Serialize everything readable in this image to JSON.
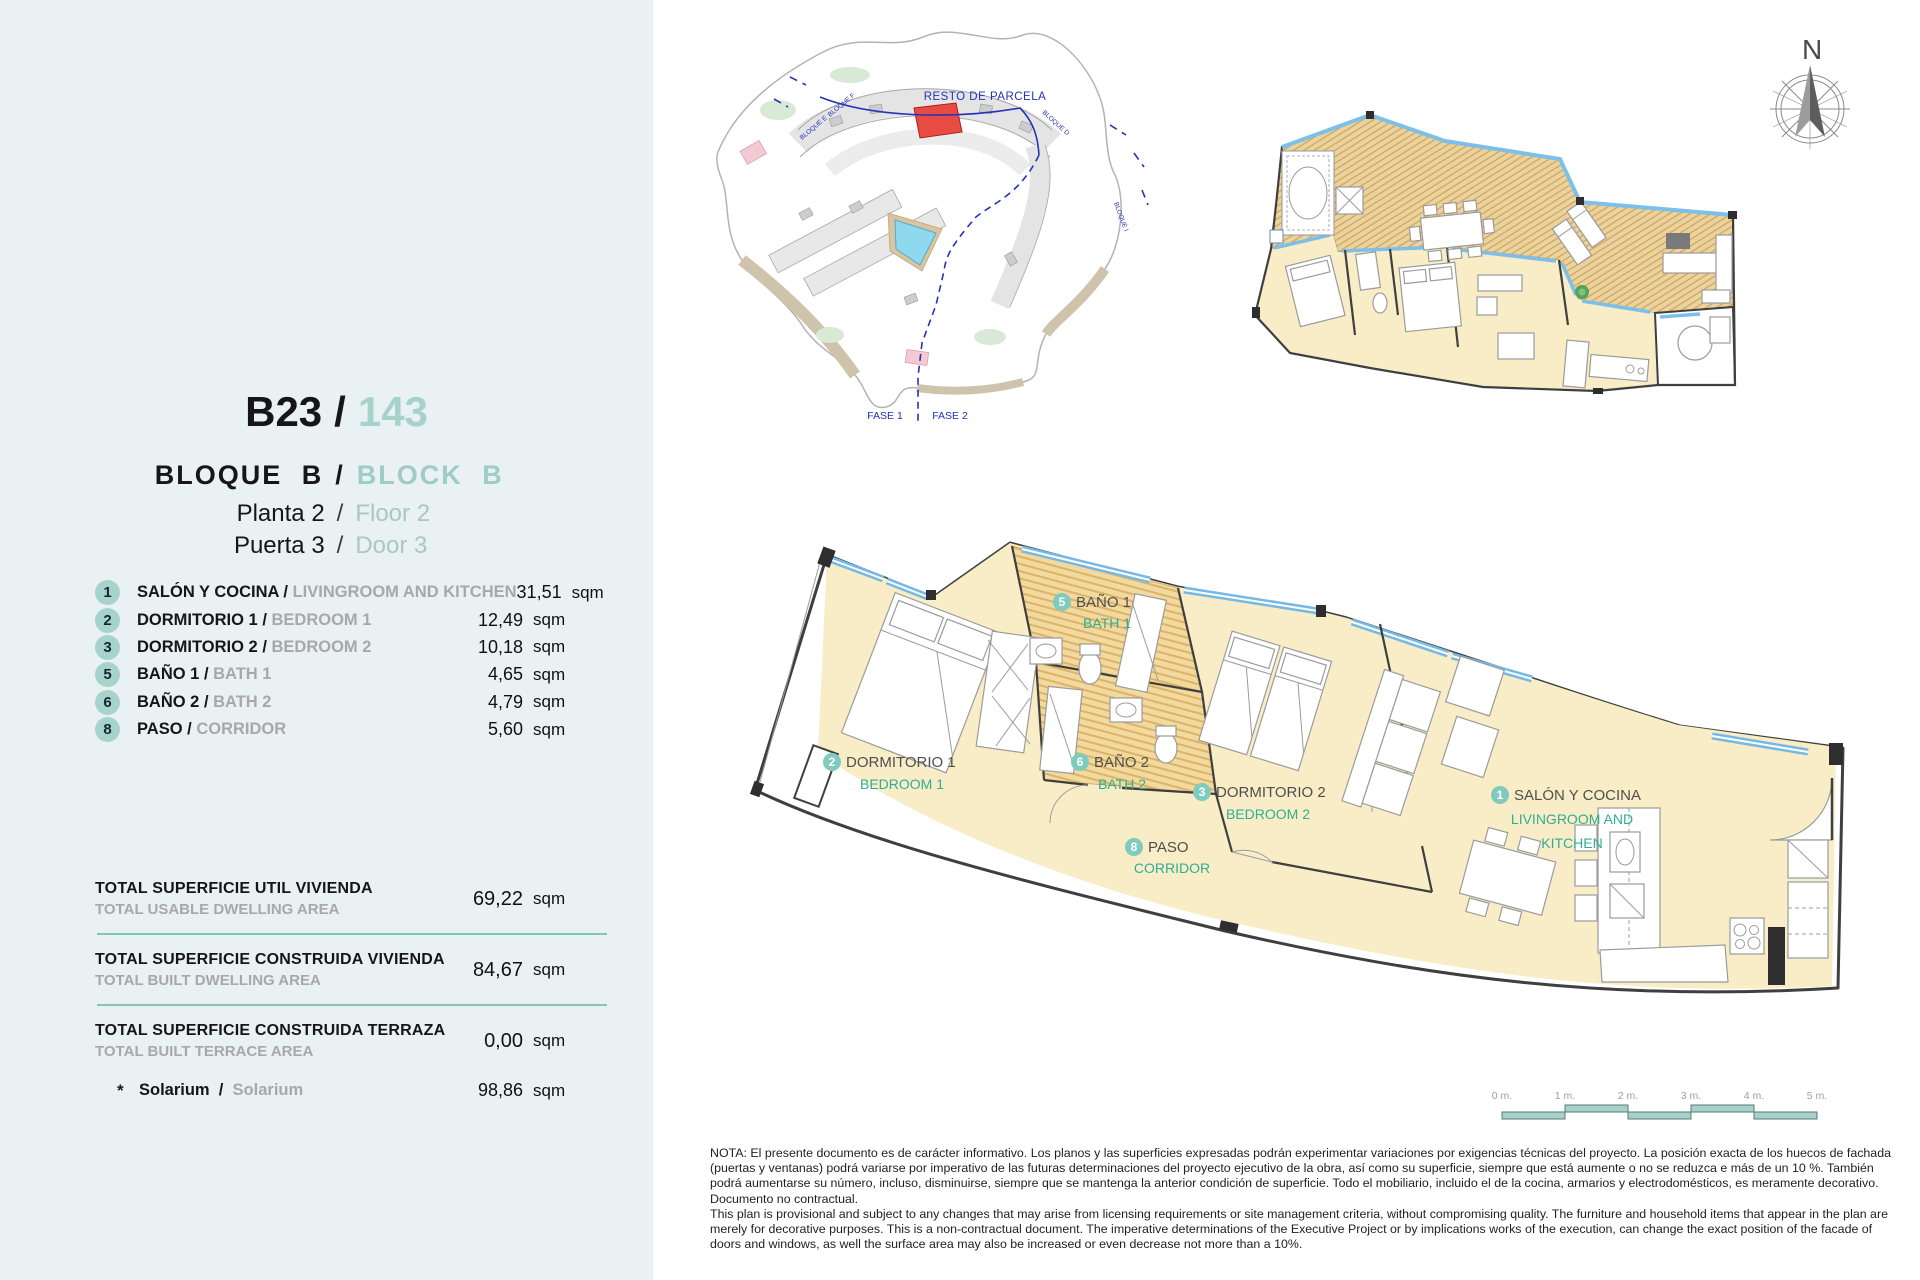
{
  "colors": {
    "panel_bg": "#e9f1f3",
    "accent_teal": "#7fc6bd",
    "badge_teal": "#a6d4cd",
    "label_teal": "#2fae96",
    "muted_gray": "#a8a8a8",
    "room_cream": "#f8edc6",
    "bath_hatch": "#f1d99f",
    "glazing_blue": "#76b9e5",
    "site_blue": "#2433b8",
    "highlight_red": "#e84b42"
  },
  "sidebar": {
    "sep": "/",
    "unit": {
      "code": "B23",
      "number": "143"
    },
    "block": {
      "es": "BLOQUE B",
      "en": "BLOCK B"
    },
    "floor": {
      "es": "Planta 2",
      "en": "Floor 2"
    },
    "door": {
      "es": "Puerta 3",
      "en": "Door 3"
    },
    "rooms": [
      {
        "num": "1",
        "es": "SALÓN Y COCINA",
        "en": "LIVINGROOM AND KITCHEN",
        "value": "31,51",
        "unit": "sqm"
      },
      {
        "num": "2",
        "es": "DORMITORIO 1",
        "en": "BEDROOM 1",
        "value": "12,49",
        "unit": "sqm"
      },
      {
        "num": "3",
        "es": "DORMITORIO 2",
        "en": "BEDROOM 2",
        "value": "10,18",
        "unit": "sqm"
      },
      {
        "num": "5",
        "es": "BAÑO 1",
        "en": "BATH 1",
        "value": "4,65",
        "unit": "sqm"
      },
      {
        "num": "6",
        "es": "BAÑO 2",
        "en": "BATH 2",
        "value": "4,79",
        "unit": "sqm"
      },
      {
        "num": "8",
        "es": "PASO",
        "en": "CORRIDOR",
        "value": "5,60",
        "unit": "sqm"
      }
    ],
    "totals": [
      {
        "es": "TOTAL SUPERFICIE UTIL VIVIENDA",
        "en": "TOTAL USABLE DWELLING AREA",
        "value": "69,22",
        "unit": "sqm"
      },
      {
        "es": "TOTAL SUPERFICIE CONSTRUIDA VIVIENDA",
        "en": "TOTAL BUILT DWELLING AREA",
        "value": "84,67",
        "unit": "sqm"
      },
      {
        "es": "TOTAL SUPERFICIE CONSTRUIDA TERRAZA",
        "en": "TOTAL BUILT TERRACE AREA",
        "value": "0,00",
        "unit": "sqm"
      }
    ],
    "solarium": {
      "star": "*",
      "es": "Solarium",
      "en": "Solarium",
      "value": "98,86",
      "unit": "sqm"
    }
  },
  "site_plan": {
    "resto": "RESTO DE PARCELA",
    "fase1": "FASE 1",
    "fase2": "FASE 2",
    "bloques": [
      "BLOQUE E",
      "BLOQUE F",
      "BLOQUE D",
      "BLOQUE I"
    ]
  },
  "north_label": "N",
  "main_plan": {
    "labels": {
      "salon": {
        "num": "1",
        "es": "SALÓN Y COCINA",
        "en1": "LIVINGROOM AND",
        "en2": "KITCHEN"
      },
      "dorm1": {
        "num": "2",
        "es": "DORMITORIO 1",
        "en": "BEDROOM 1"
      },
      "dorm2": {
        "num": "3",
        "es": "DORMITORIO 2",
        "en": "BEDROOM 2"
      },
      "bath1": {
        "num": "5",
        "es": "BAÑO 1",
        "en": "BATH 1"
      },
      "bath2": {
        "num": "6",
        "es": "BAÑO 2",
        "en": "BATH 2"
      },
      "paso": {
        "num": "8",
        "es": "PASO",
        "en": "CORRIDOR"
      }
    }
  },
  "scale_bar": {
    "labels": [
      "0 m.",
      "1 m.",
      "2 m.",
      "3 m.",
      "4 m.",
      "5 m."
    ]
  },
  "note": {
    "es": "NOTA: El presente documento es de carácter informativo. Los planos y las superficies expresadas podrán experimentar variaciones por exigencias técnicas del proyecto. La posición exacta de los huecos de fachada (puertas y ventanas) podrá variarse por imperativo de las futuras determinaciones del proyecto ejecutivo de la obra, así como su superficie, siempre que está aumente o no se reduzca e más de un 10 %. También podrá aumentarse su número, incluso, disminuirse, siempre que se mantenga la anterior condición de superficie. Todo el mobiliario, incluido el de la cocina, armarios y electrodomésticos, es meramente decorativo. Documento no contractual.",
    "en": "This plan is provisional and subject to any changes that may arise from licensing requirements or site management criteria, without compromising quality. The furniture and household items that appear in the plan are merely for decorative purposes. This is a non-contractual document. The imperative determinations of the Executive Project or by implications works of the execution, can change the exact position of the facade of doors and windows, as well the surface area may also be increased or even decrease not more than a 10%."
  }
}
